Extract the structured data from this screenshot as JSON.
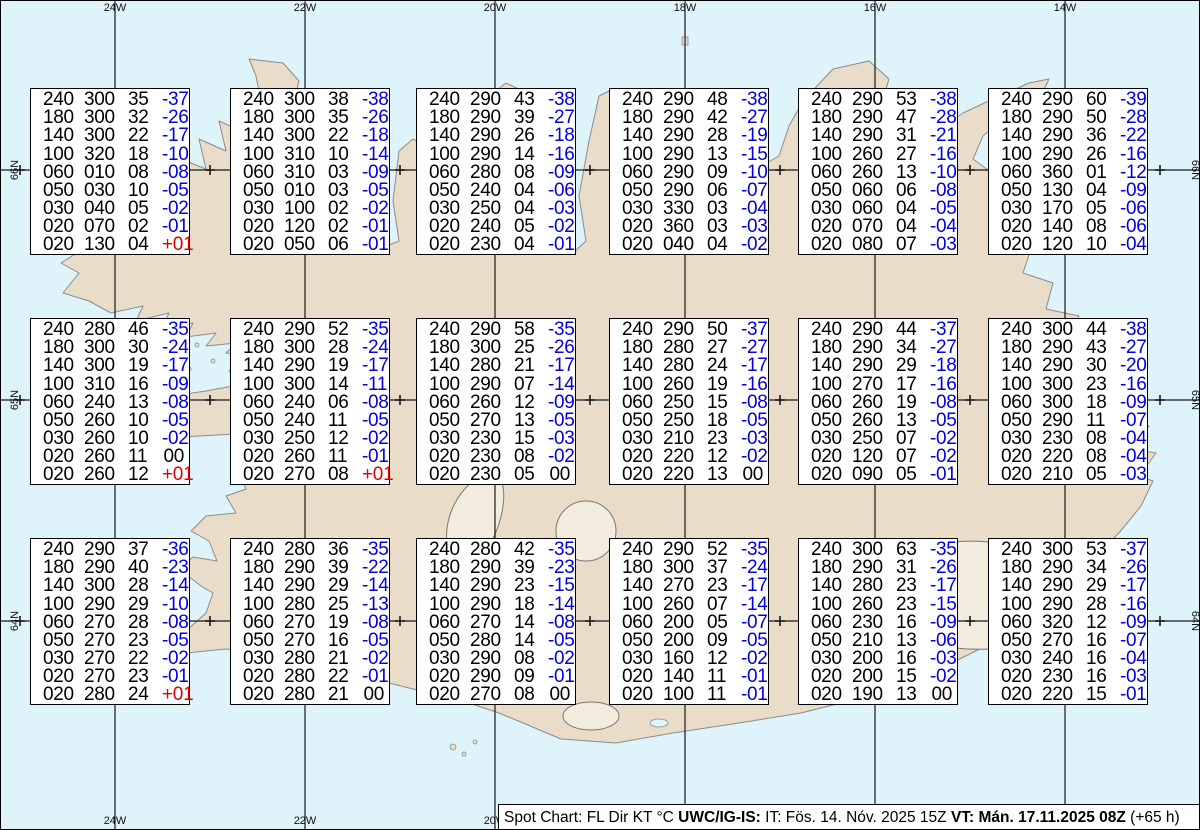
{
  "map": {
    "colors": {
      "water": "#def3fa",
      "land": "#e9dcc8",
      "coast": "#8c8c8c",
      "glacier_fill": "#f2ecdf",
      "glacier_stroke": "#777777",
      "graticule": "#1a1a1a",
      "temp_negative": "#0000e0",
      "temp_positive": "#e00000",
      "box_border": "#000000"
    },
    "meridians": [
      {
        "label": "24W",
        "x": 114
      },
      {
        "label": "22W",
        "x": 304
      },
      {
        "label": "20W",
        "x": 494
      },
      {
        "label": "18W",
        "x": 684
      },
      {
        "label": "16W",
        "x": 874
      },
      {
        "label": "14W",
        "x": 1064
      }
    ],
    "parallels": [
      {
        "label": "66N",
        "y": 169
      },
      {
        "label": "65N",
        "y": 399
      },
      {
        "label": "64N",
        "y": 620
      }
    ],
    "cross_xs": [
      19,
      114,
      209,
      304,
      399,
      494,
      589,
      684,
      779,
      874,
      969,
      1064,
      1159
    ]
  },
  "spot_boxes": [
    {
      "x": 29,
      "y": 87,
      "rows": [
        [
          "240",
          "300",
          "35",
          "-37"
        ],
        [
          "180",
          "300",
          "32",
          "-26"
        ],
        [
          "140",
          "300",
          "22",
          "-17"
        ],
        [
          "100",
          "320",
          "18",
          "-10"
        ],
        [
          "060",
          "010",
          "08",
          "-08"
        ],
        [
          "050",
          "030",
          "10",
          "-05"
        ],
        [
          "030",
          "040",
          "05",
          "-02"
        ],
        [
          "020",
          "070",
          "02",
          "-01"
        ],
        [
          "020",
          "130",
          "04",
          "+01"
        ]
      ]
    },
    {
      "x": 229,
      "y": 87,
      "rows": [
        [
          "240",
          "300",
          "38",
          "-38"
        ],
        [
          "180",
          "300",
          "35",
          "-26"
        ],
        [
          "140",
          "300",
          "22",
          "-18"
        ],
        [
          "100",
          "310",
          "10",
          "-14"
        ],
        [
          "060",
          "310",
          "03",
          "-09"
        ],
        [
          "050",
          "010",
          "03",
          "-05"
        ],
        [
          "030",
          "100",
          "02",
          "-02"
        ],
        [
          "020",
          "120",
          "02",
          "-01"
        ],
        [
          "020",
          "050",
          "06",
          "-01"
        ]
      ]
    },
    {
      "x": 415,
      "y": 87,
      "rows": [
        [
          "240",
          "290",
          "43",
          "-38"
        ],
        [
          "180",
          "290",
          "39",
          "-27"
        ],
        [
          "140",
          "290",
          "26",
          "-18"
        ],
        [
          "100",
          "290",
          "14",
          "-16"
        ],
        [
          "060",
          "280",
          "08",
          "-09"
        ],
        [
          "050",
          "240",
          "04",
          "-06"
        ],
        [
          "030",
          "250",
          "04",
          "-03"
        ],
        [
          "020",
          "240",
          "05",
          "-02"
        ],
        [
          "020",
          "230",
          "04",
          "-01"
        ]
      ]
    },
    {
      "x": 608,
      "y": 87,
      "rows": [
        [
          "240",
          "290",
          "48",
          "-38"
        ],
        [
          "180",
          "290",
          "42",
          "-27"
        ],
        [
          "140",
          "290",
          "28",
          "-19"
        ],
        [
          "100",
          "290",
          "13",
          "-15"
        ],
        [
          "060",
          "290",
          "09",
          "-10"
        ],
        [
          "050",
          "290",
          "06",
          "-07"
        ],
        [
          "030",
          "330",
          "03",
          "-04"
        ],
        [
          "020",
          "360",
          "03",
          "-03"
        ],
        [
          "020",
          "040",
          "04",
          "-02"
        ]
      ]
    },
    {
      "x": 797,
      "y": 87,
      "rows": [
        [
          "240",
          "290",
          "53",
          "-38"
        ],
        [
          "180",
          "290",
          "47",
          "-28"
        ],
        [
          "140",
          "290",
          "31",
          "-21"
        ],
        [
          "100",
          "260",
          "27",
          "-16"
        ],
        [
          "060",
          "260",
          "13",
          "-10"
        ],
        [
          "050",
          "060",
          "06",
          "-08"
        ],
        [
          "030",
          "060",
          "04",
          "-05"
        ],
        [
          "020",
          "070",
          "04",
          "-04"
        ],
        [
          "020",
          "080",
          "07",
          "-03"
        ]
      ]
    },
    {
      "x": 987,
      "y": 87,
      "rows": [
        [
          "240",
          "290",
          "60",
          "-39"
        ],
        [
          "180",
          "290",
          "50",
          "-28"
        ],
        [
          "140",
          "290",
          "36",
          "-22"
        ],
        [
          "100",
          "290",
          "26",
          "-16"
        ],
        [
          "060",
          "360",
          "01",
          "-12"
        ],
        [
          "050",
          "130",
          "04",
          "-09"
        ],
        [
          "030",
          "170",
          "05",
          "-06"
        ],
        [
          "020",
          "140",
          "08",
          "-06"
        ],
        [
          "020",
          "120",
          "10",
          "-04"
        ]
      ]
    },
    {
      "x": 29,
      "y": 317,
      "rows": [
        [
          "240",
          "280",
          "46",
          "-35"
        ],
        [
          "180",
          "300",
          "30",
          "-24"
        ],
        [
          "140",
          "300",
          "19",
          "-17"
        ],
        [
          "100",
          "310",
          "16",
          "-09"
        ],
        [
          "060",
          "240",
          "13",
          "-08"
        ],
        [
          "050",
          "260",
          "10",
          "-05"
        ],
        [
          "030",
          "260",
          "10",
          "-02"
        ],
        [
          "020",
          "260",
          "11",
          "00"
        ],
        [
          "020",
          "260",
          "12",
          "+01"
        ]
      ]
    },
    {
      "x": 229,
      "y": 317,
      "rows": [
        [
          "240",
          "290",
          "52",
          "-35"
        ],
        [
          "180",
          "300",
          "28",
          "-24"
        ],
        [
          "140",
          "290",
          "19",
          "-17"
        ],
        [
          "100",
          "300",
          "14",
          "-11"
        ],
        [
          "060",
          "240",
          "06",
          "-08"
        ],
        [
          "050",
          "240",
          "11",
          "-05"
        ],
        [
          "030",
          "250",
          "12",
          "-02"
        ],
        [
          "020",
          "260",
          "11",
          "-01"
        ],
        [
          "020",
          "270",
          "08",
          "+01"
        ]
      ]
    },
    {
      "x": 415,
      "y": 317,
      "rows": [
        [
          "240",
          "290",
          "58",
          "-35"
        ],
        [
          "180",
          "300",
          "25",
          "-26"
        ],
        [
          "140",
          "280",
          "21",
          "-17"
        ],
        [
          "100",
          "290",
          "07",
          "-14"
        ],
        [
          "060",
          "260",
          "12",
          "-09"
        ],
        [
          "050",
          "270",
          "13",
          "-05"
        ],
        [
          "030",
          "230",
          "15",
          "-03"
        ],
        [
          "020",
          "230",
          "08",
          "-02"
        ],
        [
          "020",
          "230",
          "05",
          "00"
        ]
      ]
    },
    {
      "x": 608,
      "y": 317,
      "rows": [
        [
          "240",
          "290",
          "50",
          "-37"
        ],
        [
          "180",
          "280",
          "27",
          "-27"
        ],
        [
          "140",
          "280",
          "24",
          "-17"
        ],
        [
          "100",
          "260",
          "19",
          "-16"
        ],
        [
          "060",
          "250",
          "15",
          "-08"
        ],
        [
          "050",
          "250",
          "18",
          "-05"
        ],
        [
          "030",
          "210",
          "23",
          "-03"
        ],
        [
          "020",
          "220",
          "12",
          "-02"
        ],
        [
          "020",
          "220",
          "13",
          "00"
        ]
      ]
    },
    {
      "x": 797,
      "y": 317,
      "rows": [
        [
          "240",
          "290",
          "44",
          "-37"
        ],
        [
          "180",
          "290",
          "34",
          "-27"
        ],
        [
          "140",
          "290",
          "29",
          "-18"
        ],
        [
          "100",
          "270",
          "17",
          "-16"
        ],
        [
          "060",
          "260",
          "19",
          "-08"
        ],
        [
          "050",
          "260",
          "13",
          "-05"
        ],
        [
          "030",
          "250",
          "07",
          "-02"
        ],
        [
          "020",
          "120",
          "07",
          "-02"
        ],
        [
          "020",
          "090",
          "05",
          "-01"
        ]
      ]
    },
    {
      "x": 987,
      "y": 317,
      "rows": [
        [
          "240",
          "300",
          "44",
          "-38"
        ],
        [
          "180",
          "290",
          "43",
          "-27"
        ],
        [
          "140",
          "290",
          "30",
          "-20"
        ],
        [
          "100",
          "300",
          "23",
          "-16"
        ],
        [
          "060",
          "300",
          "18",
          "-09"
        ],
        [
          "050",
          "290",
          "11",
          "-07"
        ],
        [
          "030",
          "230",
          "08",
          "-04"
        ],
        [
          "020",
          "220",
          "08",
          "-04"
        ],
        [
          "020",
          "210",
          "05",
          "-03"
        ]
      ]
    },
    {
      "x": 29,
      "y": 537,
      "rows": [
        [
          "240",
          "290",
          "37",
          "-36"
        ],
        [
          "180",
          "290",
          "40",
          "-23"
        ],
        [
          "140",
          "300",
          "28",
          "-14"
        ],
        [
          "100",
          "290",
          "29",
          "-10"
        ],
        [
          "060",
          "270",
          "28",
          "-08"
        ],
        [
          "050",
          "270",
          "23",
          "-05"
        ],
        [
          "030",
          "270",
          "22",
          "-02"
        ],
        [
          "020",
          "270",
          "23",
          "-01"
        ],
        [
          "020",
          "280",
          "24",
          "+01"
        ]
      ]
    },
    {
      "x": 229,
      "y": 537,
      "rows": [
        [
          "240",
          "280",
          "36",
          "-35"
        ],
        [
          "180",
          "290",
          "39",
          "-22"
        ],
        [
          "140",
          "290",
          "29",
          "-14"
        ],
        [
          "100",
          "280",
          "25",
          "-13"
        ],
        [
          "060",
          "270",
          "19",
          "-08"
        ],
        [
          "050",
          "270",
          "16",
          "-05"
        ],
        [
          "030",
          "280",
          "21",
          "-02"
        ],
        [
          "020",
          "280",
          "22",
          "-01"
        ],
        [
          "020",
          "280",
          "21",
          "00"
        ]
      ]
    },
    {
      "x": 415,
      "y": 537,
      "rows": [
        [
          "240",
          "280",
          "42",
          "-35"
        ],
        [
          "180",
          "290",
          "39",
          "-23"
        ],
        [
          "140",
          "290",
          "23",
          "-15"
        ],
        [
          "100",
          "290",
          "18",
          "-14"
        ],
        [
          "060",
          "270",
          "14",
          "-08"
        ],
        [
          "050",
          "280",
          "14",
          "-05"
        ],
        [
          "030",
          "290",
          "08",
          "-02"
        ],
        [
          "020",
          "290",
          "09",
          "-01"
        ],
        [
          "020",
          "270",
          "08",
          "00"
        ]
      ]
    },
    {
      "x": 608,
      "y": 537,
      "rows": [
        [
          "240",
          "290",
          "52",
          "-35"
        ],
        [
          "180",
          "300",
          "37",
          "-24"
        ],
        [
          "140",
          "270",
          "23",
          "-17"
        ],
        [
          "100",
          "260",
          "07",
          "-14"
        ],
        [
          "060",
          "200",
          "05",
          "-07"
        ],
        [
          "050",
          "200",
          "09",
          "-05"
        ],
        [
          "030",
          "160",
          "12",
          "-02"
        ],
        [
          "020",
          "140",
          "11",
          "-01"
        ],
        [
          "020",
          "100",
          "11",
          "-01"
        ]
      ]
    },
    {
      "x": 797,
      "y": 537,
      "rows": [
        [
          "240",
          "300",
          "63",
          "-35"
        ],
        [
          "180",
          "290",
          "31",
          "-26"
        ],
        [
          "140",
          "280",
          "23",
          "-17"
        ],
        [
          "100",
          "260",
          "23",
          "-15"
        ],
        [
          "060",
          "230",
          "16",
          "-09"
        ],
        [
          "050",
          "210",
          "13",
          "-06"
        ],
        [
          "030",
          "200",
          "16",
          "-03"
        ],
        [
          "020",
          "200",
          "15",
          "-02"
        ],
        [
          "020",
          "190",
          "13",
          "00"
        ]
      ]
    },
    {
      "x": 987,
      "y": 537,
      "rows": [
        [
          "240",
          "300",
          "53",
          "-37"
        ],
        [
          "180",
          "290",
          "34",
          "-26"
        ],
        [
          "140",
          "290",
          "29",
          "-17"
        ],
        [
          "100",
          "290",
          "28",
          "-16"
        ],
        [
          "060",
          "320",
          "12",
          "-09"
        ],
        [
          "050",
          "270",
          "16",
          "-07"
        ],
        [
          "030",
          "240",
          "16",
          "-04"
        ],
        [
          "020",
          "230",
          "16",
          "-03"
        ],
        [
          "020",
          "220",
          "15",
          "-01"
        ]
      ]
    }
  ],
  "status_bar": {
    "segments": [
      {
        "text": "Spot Chart: FL Dir KT °C ",
        "bold": false
      },
      {
        "text": "UWC/IG-IS:",
        "bold": true
      },
      {
        "text": " IT: Fös. 14. Nóv. 2025 15Z ",
        "bold": false
      },
      {
        "text": "VT: Mán. 17.11.2025 08Z",
        "bold": true
      },
      {
        "text": " (+65 h)",
        "bold": false
      }
    ]
  }
}
